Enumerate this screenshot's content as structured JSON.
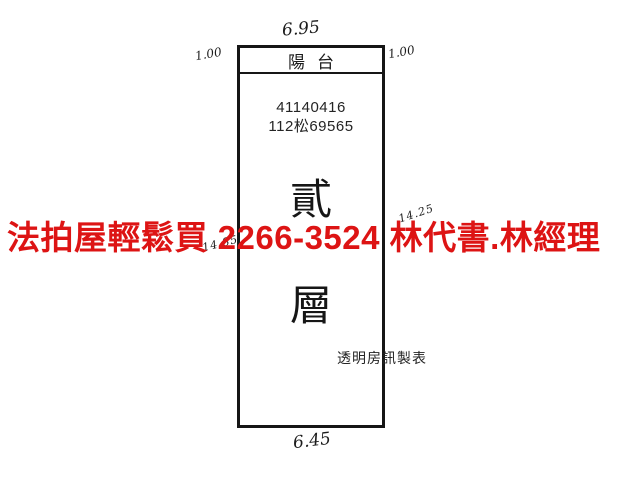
{
  "plan": {
    "balcony_label": "陽台",
    "case_number": "41140416",
    "case_code": "112松69565",
    "floor_char_1": "貳",
    "floor_char_2": "層",
    "producer_label": "透明房訊製表"
  },
  "dimensions": {
    "top_width": "6.95",
    "bottom_width": "6.45",
    "left_balcony_depth": "1.00",
    "right_balcony_depth": "1.00",
    "left_height": "14.85",
    "right_height": "14.25"
  },
  "overlay": {
    "ad_text": "法拍屋輕鬆買 2266-3524 林代書.林經理",
    "color": "#dd1414"
  },
  "colors": {
    "line": "#161616",
    "background": "#ffffff"
  }
}
